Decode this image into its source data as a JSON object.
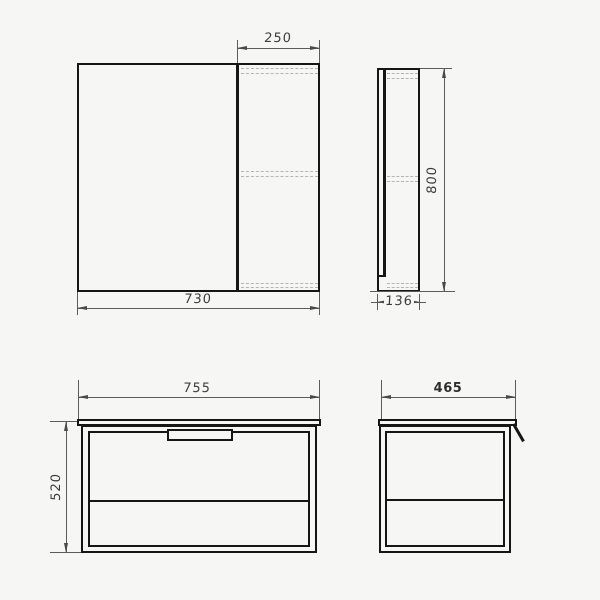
{
  "drawing": {
    "title": "bathroom furniture dimension drawing",
    "units": "mm",
    "mirror_cabinet_front": {
      "shelf_section_width": "250",
      "overall_width": "730"
    },
    "mirror_cabinet_side": {
      "overall_height": "800",
      "depth": "136"
    },
    "vanity_front": {
      "countertop_width": "755",
      "body_height": "520"
    },
    "vanity_side": {
      "countertop_depth": "465"
    }
  }
}
